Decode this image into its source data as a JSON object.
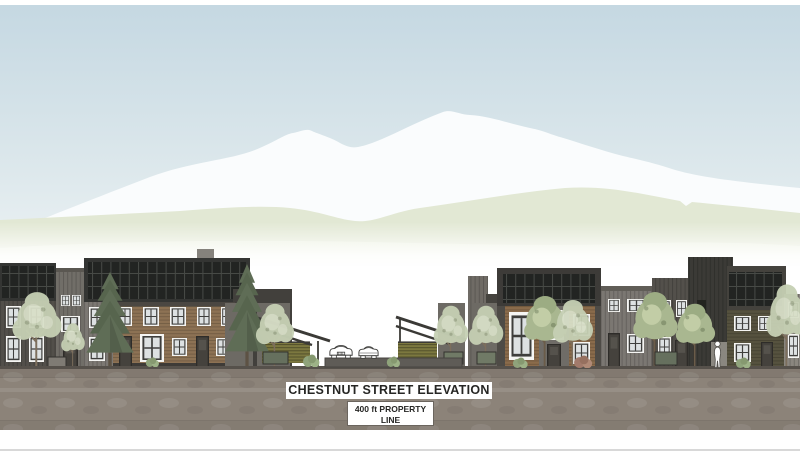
{
  "drawing": {
    "title": "CHESTNUT STREET ELEVATION",
    "property_label": {
      "line1": "400 ft PROPERTY",
      "line2": "LINE"
    }
  },
  "palette": {
    "sky_top": "#c5d8e2",
    "sky_bottom": "#e7eff2",
    "mountain_white": "#fafcfd",
    "foothill_green": "#e2e8d4",
    "ground_brown_gray": "#8c8379",
    "dark_siding": "#4e4b46",
    "brown_siding": "#8a6b4b",
    "solar_panel": "#232523",
    "louver_fence_olive": "#7c783f",
    "evergreen_tree": "#5f6d56",
    "deciduous_tree_pale": "#c6d0b4",
    "label_text": "#262624",
    "baseline_rule": "#d8d8d8"
  },
  "parts": [
    "sky",
    "mountain",
    "foothills",
    "townhomes-left",
    "street-entry-carport",
    "cars",
    "townhomes-right",
    "pedestrian",
    "street-ground"
  ]
}
